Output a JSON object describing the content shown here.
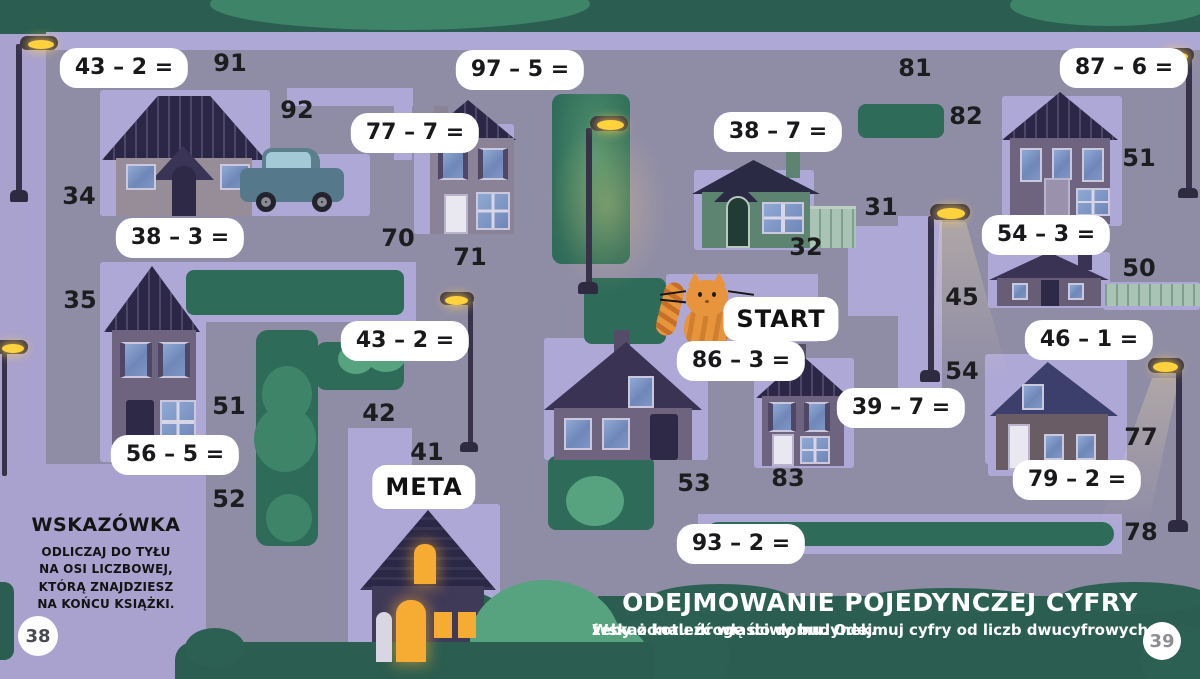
{
  "page": {
    "left_number": "38",
    "right_number": "39"
  },
  "hint": {
    "title": "WSKAZÓWKA",
    "lines": [
      "ODLICZAJ DO TYŁU",
      "NA OSI LICZBOWEJ,",
      "KTÓRĄ ZNAJDZIESZ",
      "NA KOŃCU KSIĄŻKI."
    ]
  },
  "lesson": {
    "title": "ODEJMOWANIE POJEDYNCZEJ CYFRY",
    "instruction_line1": "Wskaż kotu drogę do domu. Odejmuj cyfry od liczb dwucyfrowych,",
    "instruction_line2": "żeby odnaleźć właściwy budynek."
  },
  "markers": [
    {
      "label": "START",
      "name": "start-label-badge",
      "x": 781,
      "y": 319
    },
    {
      "label": "META",
      "name": "meta-label-badge",
      "x": 424,
      "y": 487
    }
  ],
  "problems": [
    {
      "text": "43 – 2 =",
      "x": 124,
      "y": 68
    },
    {
      "text": "97 – 5 =",
      "x": 520,
      "y": 70
    },
    {
      "text": "87 – 6 =",
      "x": 1124,
      "y": 68
    },
    {
      "text": "77 – 7 =",
      "x": 415,
      "y": 133
    },
    {
      "text": "38 – 7 =",
      "x": 778,
      "y": 132
    },
    {
      "text": "38 – 3 =",
      "x": 180,
      "y": 238
    },
    {
      "text": "54 – 3 =",
      "x": 1046,
      "y": 235
    },
    {
      "text": "43 – 2 =",
      "x": 405,
      "y": 341
    },
    {
      "text": "46 – 1 =",
      "x": 1089,
      "y": 340
    },
    {
      "text": "86 – 3 =",
      "x": 741,
      "y": 361
    },
    {
      "text": "39 – 7 =",
      "x": 901,
      "y": 408
    },
    {
      "text": "56 – 5 =",
      "x": 175,
      "y": 455
    },
    {
      "text": "79 – 2 =",
      "x": 1077,
      "y": 480
    },
    {
      "text": "93 – 2 =",
      "x": 741,
      "y": 544
    }
  ],
  "numbers": [
    {
      "text": "91",
      "x": 230,
      "y": 63
    },
    {
      "text": "92",
      "x": 297,
      "y": 110
    },
    {
      "text": "34",
      "x": 79,
      "y": 196
    },
    {
      "text": "70",
      "x": 398,
      "y": 238
    },
    {
      "text": "71",
      "x": 470,
      "y": 257
    },
    {
      "text": "81",
      "x": 915,
      "y": 68
    },
    {
      "text": "82",
      "x": 966,
      "y": 116
    },
    {
      "text": "51",
      "x": 1139,
      "y": 158
    },
    {
      "text": "31",
      "x": 881,
      "y": 207
    },
    {
      "text": "32",
      "x": 806,
      "y": 247
    },
    {
      "text": "45",
      "x": 962,
      "y": 297
    },
    {
      "text": "50",
      "x": 1139,
      "y": 268
    },
    {
      "text": "54",
      "x": 962,
      "y": 371
    },
    {
      "text": "35",
      "x": 80,
      "y": 300
    },
    {
      "text": "51",
      "x": 229,
      "y": 406
    },
    {
      "text": "42",
      "x": 379,
      "y": 413
    },
    {
      "text": "41",
      "x": 427,
      "y": 452
    },
    {
      "text": "52",
      "x": 229,
      "y": 499
    },
    {
      "text": "53",
      "x": 694,
      "y": 483
    },
    {
      "text": "83",
      "x": 788,
      "y": 478
    },
    {
      "text": "77",
      "x": 1141,
      "y": 437
    },
    {
      "text": "78",
      "x": 1141,
      "y": 532
    }
  ],
  "colors": {
    "background": "#a9a2cf",
    "road": "#8f8ca6",
    "plot": "#aea8d6",
    "green_dark": "#2e6b59",
    "green_band": "#2b5d50",
    "green_light": "#57a27f",
    "badge_bg": "#ffffff",
    "text": "#1c1c1e",
    "lamp_light": "#ffd23e",
    "cat_orange": "#e8943d"
  }
}
